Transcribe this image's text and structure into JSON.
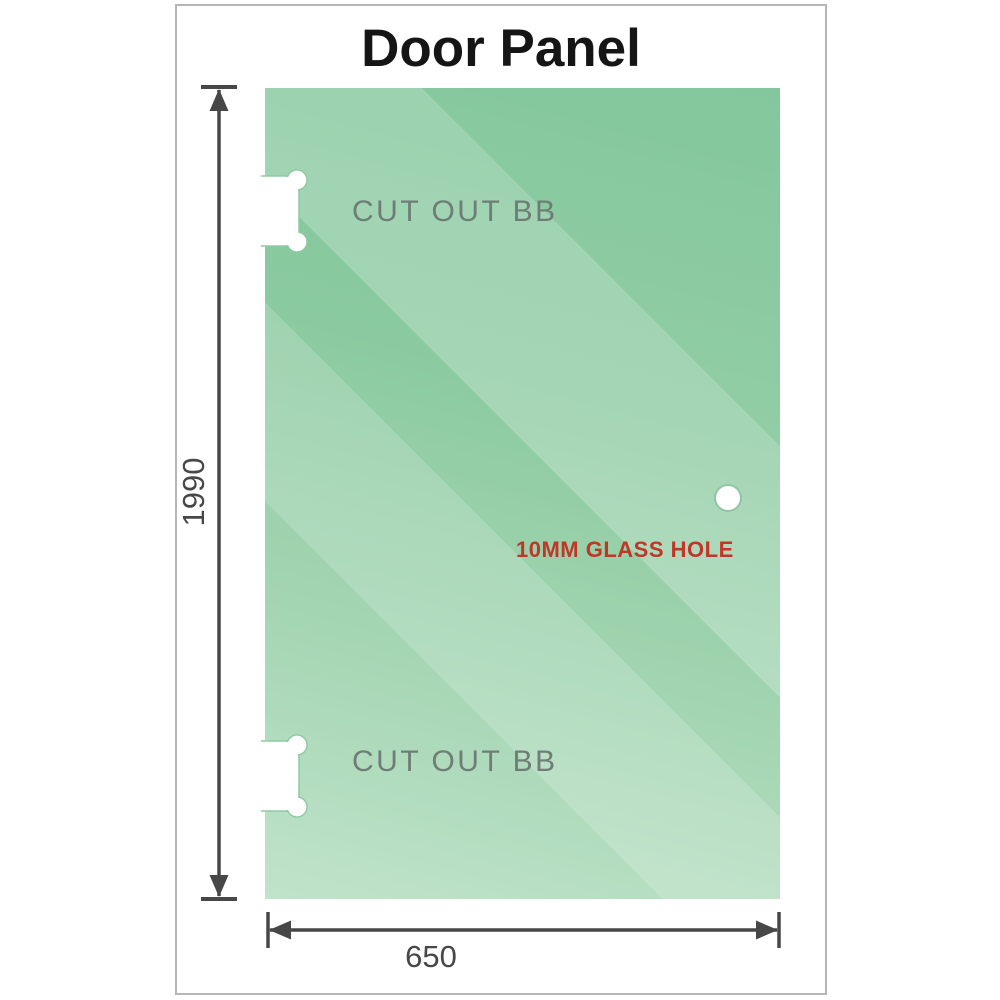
{
  "title": "Door Panel",
  "panel": {
    "cutout_top_label": "CUT OUT BB",
    "cutout_bottom_label": "CUT OUT BB",
    "glass_hole_label": "10MM GLASS HOLE"
  },
  "dimensions": {
    "height_label": "1990",
    "width_label": "650"
  },
  "colors": {
    "glass_green_dark": "#7cc496",
    "glass_green_light": "#c0e3ca",
    "dimension_gray": "#474747",
    "cutout_label_gray": "#6e7d75",
    "hole_label_red": "#c03727",
    "frame_border": "#b7b5b6",
    "cutout_fill": "#ffffff"
  }
}
